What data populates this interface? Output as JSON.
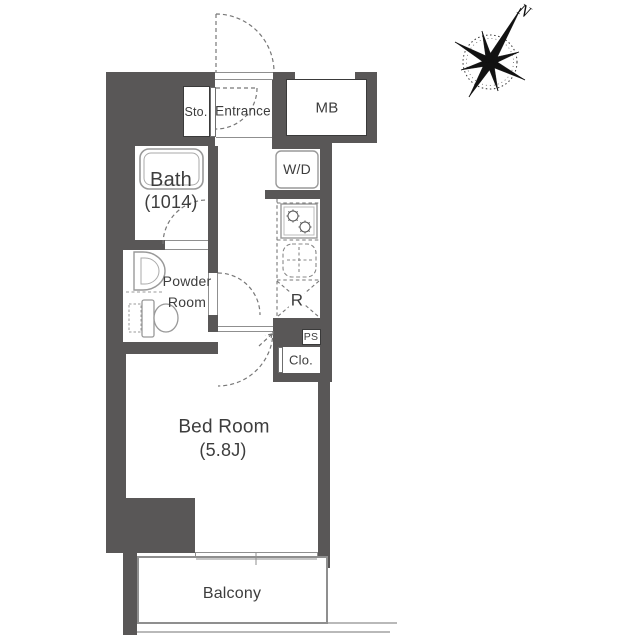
{
  "floorplan": {
    "title": "1K apartment floor plan",
    "rooms": {
      "storage": {
        "label": "Sto."
      },
      "entrance": {
        "label": "Entrance"
      },
      "meter_box": {
        "label": "MB"
      },
      "bath": {
        "label": "Bath",
        "size": "(1014)"
      },
      "washer_dryer": {
        "label": "W/D"
      },
      "powder_room": {
        "label_line1": "Powder",
        "label_line2": "Room"
      },
      "refrigerator_space": {
        "label": "R"
      },
      "pipe_space": {
        "label": "PS"
      },
      "closet": {
        "label": "Clo."
      },
      "bedroom": {
        "label": "Bed Room",
        "size": "(5.8J)"
      },
      "balcony": {
        "label": "Balcony"
      }
    },
    "compass": {
      "label": "N"
    },
    "icons": [
      "compass-rose-icon",
      "bathtub-icon",
      "toilet-icon",
      "vanity-sink-icon",
      "kitchen-sink-icon",
      "stove-icon",
      "burner-icon",
      "door-swing-arc-icon",
      "sliding-window-icon"
    ],
    "colors": {
      "wall": "#595757",
      "fixture_line": "#999999",
      "dashed_line": "#777777",
      "thin_line": "#8f8f8f",
      "text": "#3d3d3d",
      "background": "#ffffff"
    }
  }
}
